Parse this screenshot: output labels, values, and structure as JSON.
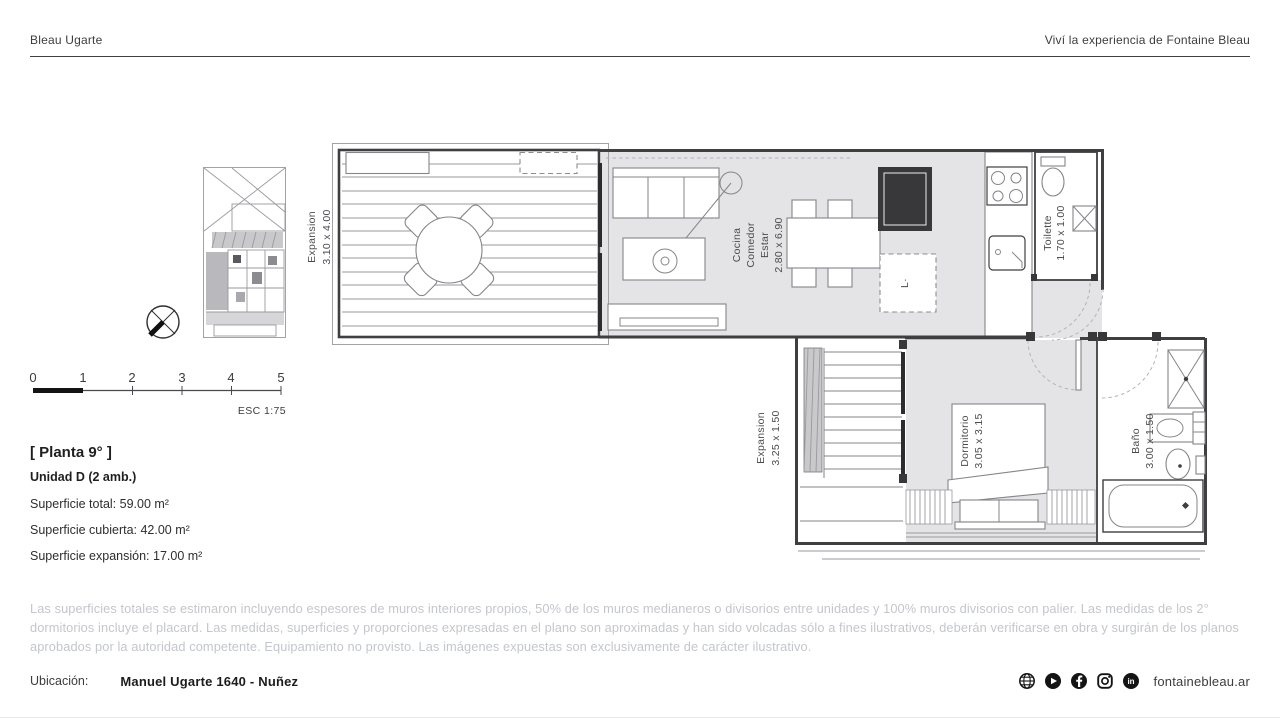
{
  "header": {
    "brand": "Bleau Ugarte",
    "tagline": "Viví la experiencia de Fontaine Bleau"
  },
  "plan": {
    "rooms": {
      "expansion_upper": {
        "name": "Expansion",
        "dims": "3.10 x 4.00"
      },
      "living": {
        "line1": "Cocina",
        "line2": "Comedor",
        "line3": "Estar",
        "dims": "2.80 x 6.90"
      },
      "toilette": {
        "name": "Toilette",
        "dims": "1.70 x 1.00"
      },
      "expansion_lower": {
        "name": "Expansion",
        "dims": "3.25 x 1.50"
      },
      "bedroom": {
        "name": "Dormitorio",
        "dims": "3.05 x 3.15"
      },
      "bathroom": {
        "name": "Baño",
        "dims": "3.00 x 1.50"
      }
    },
    "washer_label": "L·"
  },
  "scalebar": {
    "ticks": [
      "0",
      "1",
      "2",
      "3",
      "4",
      "5"
    ],
    "scale_label": "ESC 1:75"
  },
  "info": {
    "floor": "[ Planta 9° ]",
    "unit": "Unidad D (2 amb.)",
    "areas": [
      "Superficie total: 59.00 m²",
      "Superficie cubierta: 42.00 m²",
      "Superficie expansión: 17.00 m²"
    ]
  },
  "disclaimer": "Las superficies totales se estimaron incluyendo espesores de muros interiores propios, 50% de los muros medianeros o divisorios entre unidades y 100% muros divisorios con palier. Las medidas de los 2° dormitorios incluye el placard. Las medidas, superficies y proporciones expresadas en el plano son aproximadas y han sido volcadas sólo a fines ilustrativos, deberán verificarse en obra y surgirán de los planos aprobados por la autoridad competente. Equipamiento no provisto. Las imágenes expuestas son exclusivamente de carácter ilustrativo.",
  "footer": {
    "location_label": "Ubicación:",
    "address": "Manuel Ugarte 1640 - Nuñez",
    "website": "fontainebleau.ar",
    "icons": [
      "globe",
      "youtube",
      "facebook",
      "instagram",
      "linkedin"
    ]
  },
  "colors": {
    "ink": "#3a3a3c",
    "plan_line": "#3f3f42",
    "room_fill": "#e4e4e6",
    "muted_text": "#c3c6cb"
  }
}
